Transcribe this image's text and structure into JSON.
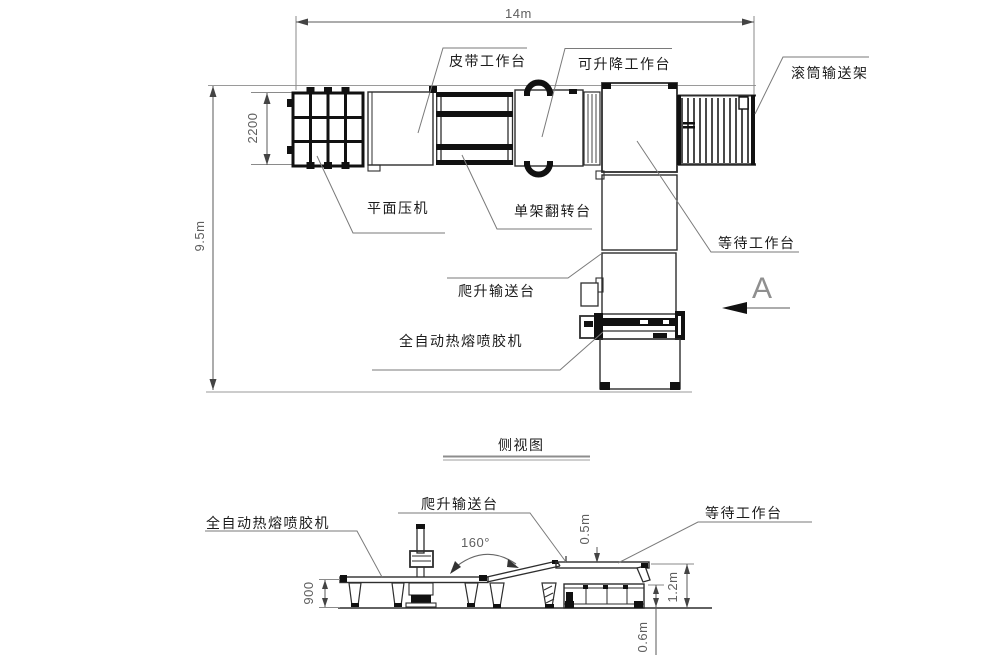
{
  "drawing": {
    "type": "equipment-layout-plan",
    "view_label": "A",
    "side_view_title": "侧视图",
    "plan": {
      "labels": {
        "belt_table": "皮带工作台",
        "lift_table": "可升降工作台",
        "roller_rack": "滚筒输送架",
        "flat_press": "平面压机",
        "flip_table": "单架翻转台",
        "waiting_table": "等待工作台",
        "climb_conveyor": "爬升输送台",
        "glue_machine": "全自动热熔喷胶机"
      },
      "dimensions": {
        "total_length": "14m",
        "press_depth": "2200",
        "total_width": "9.5m"
      }
    },
    "side": {
      "labels": {
        "glue_machine": "全自动热熔喷胶机",
        "climb_conveyor": "爬升输送台",
        "waiting_table": "等待工作台"
      },
      "dimensions": {
        "table_height": "900",
        "drop_height": "0.5m",
        "platform_height": "1.2m",
        "base_height": "0.6m",
        "ramp_angle": "160°"
      }
    },
    "colors": {
      "background": "#ffffff",
      "line": "#2e2e2e",
      "heavy": "#111111",
      "dim": "#5f5f5f",
      "leader": "#7a7a7a",
      "label": "#1c1c1c"
    }
  }
}
